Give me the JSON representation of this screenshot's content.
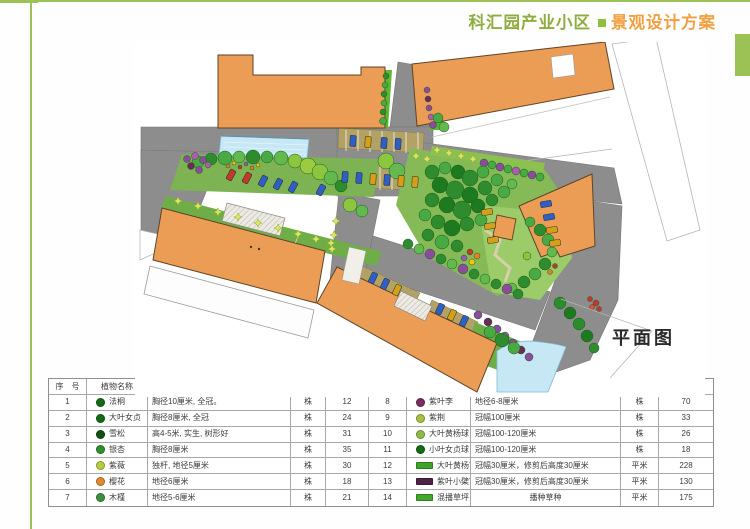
{
  "header": {
    "project_name": "科汇园产业小区",
    "bullet": "■",
    "doc_title": "景观设计方案"
  },
  "plan": {
    "label": "平面图",
    "features": [
      "buildings",
      "roads",
      "parking-lots",
      "pool",
      "central-garden",
      "pavilion",
      "lawns",
      "tree-rows"
    ]
  },
  "colors": {
    "accent_green": "#9cc255",
    "title_green": "#8fad3e",
    "title_orange": "#f0a040",
    "building_orange": "#eb9d55",
    "road_gray": "#8d8d8d",
    "water_blue": "#c6e8f4"
  },
  "table": {
    "headers": {
      "index": "序　号",
      "name": "植物名称",
      "spec": "规格　(cm)",
      "unit": "单　位",
      "qty": "数　量"
    },
    "left_rows": [
      {
        "no": "1",
        "name": "法桐",
        "spec": "胸径10厘米, 全冠。",
        "unit": "株",
        "qty": "12",
        "icon": "#156b15"
      },
      {
        "no": "2",
        "name": "大叶女贞",
        "spec": "胸径8厘米, 全冠",
        "unit": "株",
        "qty": "24",
        "icon": "#156b15"
      },
      {
        "no": "3",
        "name": "雪松",
        "spec": "高4-5米, 实生, 树形好",
        "unit": "株",
        "qty": "31",
        "icon": "#145214"
      },
      {
        "no": "4",
        "name": "银杏",
        "spec": "胸径8厘米",
        "unit": "株",
        "qty": "35",
        "icon": "#2f8f2f"
      },
      {
        "no": "5",
        "name": "紫薇",
        "spec": "独杆, 地径5厘米",
        "unit": "株",
        "qty": "30",
        "icon": "#b8cc3e"
      },
      {
        "no": "6",
        "name": "樱花",
        "spec": "地径6厘米",
        "unit": "株",
        "qty": "18",
        "icon": "#e08a30"
      },
      {
        "no": "7",
        "name": "木槿",
        "spec": "地径5-6厘米",
        "unit": "株",
        "qty": "21",
        "icon": "#3f8f3f"
      }
    ],
    "right_rows": [
      {
        "no": "8",
        "name": "紫叶李",
        "spec": "地径6-8厘米",
        "unit": "株",
        "qty": "70",
        "icon": "#7c2d62"
      },
      {
        "no": "9",
        "name": "紫荆",
        "spec": "冠幅100厘米",
        "unit": "株",
        "qty": "33",
        "icon": "#a8bf3f"
      },
      {
        "no": "10",
        "name": "大叶黄杨球",
        "spec": "冠幅100-120厘米",
        "unit": "株",
        "qty": "26",
        "icon": "#8fba4a"
      },
      {
        "no": "11",
        "name": "小叶女贞球",
        "spec": "冠幅100-120厘米",
        "unit": "株",
        "qty": "18",
        "icon": "#156b15"
      },
      {
        "no": "12",
        "name": "大叶黄杨篱",
        "spec": "冠幅30厘米，修剪后高度30厘米",
        "unit": "平米",
        "qty": "228",
        "icon": "#3fa32a"
      },
      {
        "no": "13",
        "name": "紫叶小檗篱",
        "spec": "冠幅30厘米，修剪后高度30厘米",
        "unit": "平米",
        "qty": "130",
        "icon": "#4c2545"
      },
      {
        "no": "14",
        "name": "混播草坪",
        "spec": "播种草种",
        "unit": "平米",
        "qty": "175",
        "icon": "#44a82e"
      }
    ]
  }
}
